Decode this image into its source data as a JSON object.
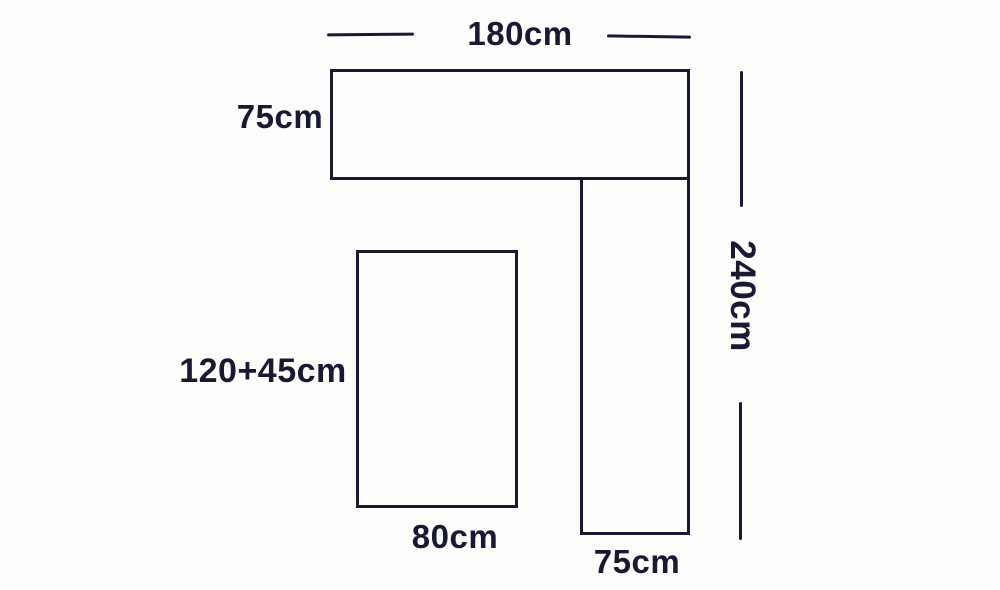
{
  "diagram": {
    "description": "corner-sofa-and-table dimension diagram",
    "background_color": "#fdfdfc",
    "ink_color": "#191933",
    "labels": {
      "top_width": "180cm",
      "top_height": "75cm",
      "right_total_height": "240cm",
      "left_height": "120+45cm",
      "left_width": "80cm",
      "right_width": "75cm"
    }
  }
}
